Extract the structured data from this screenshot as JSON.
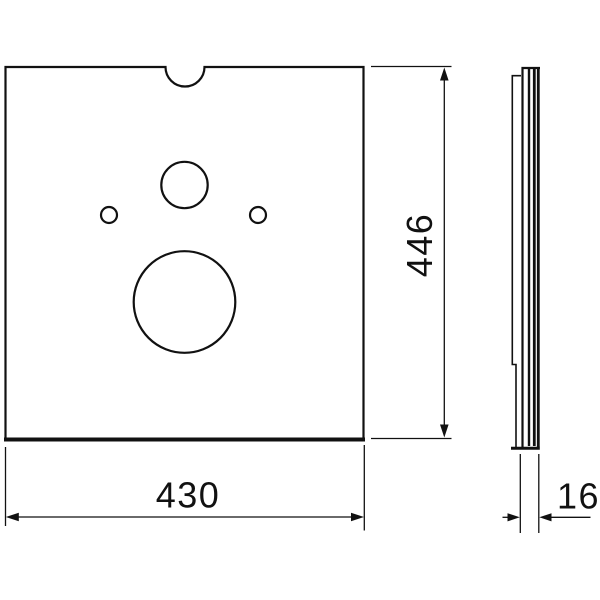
{
  "canvas": {
    "background": "#ffffff",
    "line_color": "#111111"
  },
  "drawing": {
    "kind": "technical-dimension-drawing",
    "dimensions": {
      "width": {
        "label": "430",
        "orientation": "horizontal",
        "position": "below-front-view"
      },
      "height": {
        "label": "446",
        "orientation": "vertical",
        "position": "right-of-front-view"
      },
      "thickness": {
        "label": "16",
        "orientation": "horizontal",
        "position": "below-side-view"
      }
    }
  }
}
